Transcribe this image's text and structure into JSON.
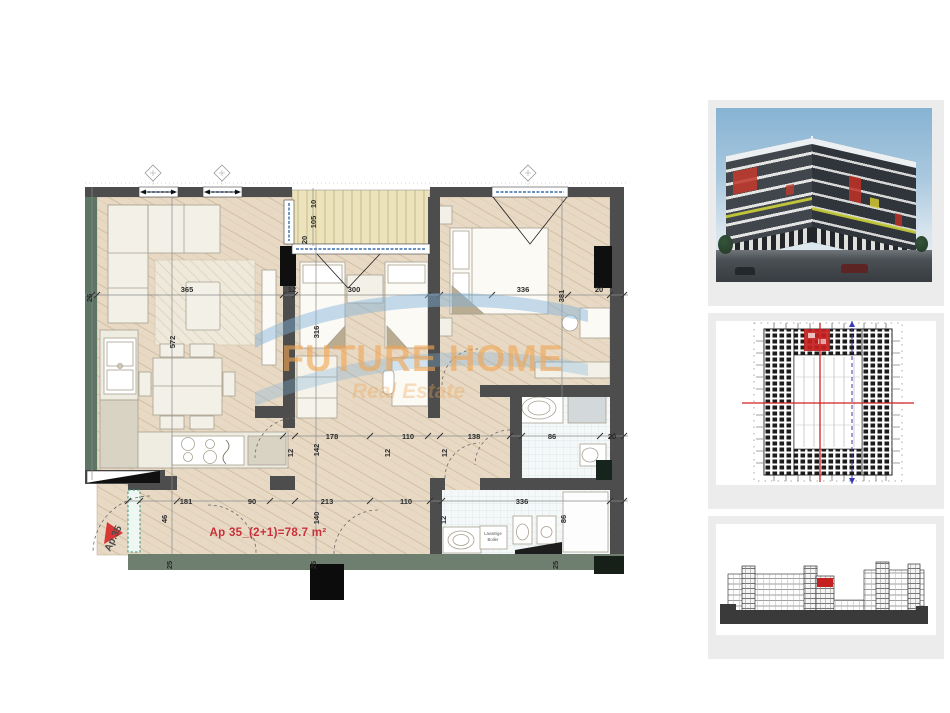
{
  "plan": {
    "apartment_label": "Ap 35_(2+1)=78.7 m²",
    "entrance_label": "Ap.35",
    "boiler_label_line1": "Lavatrige",
    "boiler_label_line2": "Boiler",
    "watermark_line1": "FUTURE HOME",
    "watermark_line2": "Real Estate",
    "dimensions": [
      {
        "t": "25",
        "x": 12,
        "y": 138,
        "r": -90
      },
      {
        "t": "365",
        "x": 107,
        "y": 132,
        "r": 0
      },
      {
        "t": "12",
        "x": 212,
        "y": 132,
        "r": 0
      },
      {
        "t": "300",
        "x": 274,
        "y": 132,
        "r": 0
      },
      {
        "t": "336",
        "x": 443,
        "y": 132,
        "r": 0
      },
      {
        "t": "381",
        "x": 484,
        "y": 136,
        "r": -90
      },
      {
        "t": "20",
        "x": 519,
        "y": 132,
        "r": 0
      },
      {
        "t": "572",
        "x": 95,
        "y": 182,
        "r": -90
      },
      {
        "t": "316",
        "x": 239,
        "y": 172,
        "r": -90
      },
      {
        "t": "10",
        "x": 236,
        "y": 44,
        "r": -90
      },
      {
        "t": "105",
        "x": 236,
        "y": 62,
        "r": -90
      },
      {
        "t": "20",
        "x": 227,
        "y": 80,
        "r": -90
      },
      {
        "t": "178",
        "x": 252,
        "y": 279,
        "r": 0
      },
      {
        "t": "110",
        "x": 328,
        "y": 279,
        "r": 0
      },
      {
        "t": "138",
        "x": 394,
        "y": 279,
        "r": 0
      },
      {
        "t": "86",
        "x": 472,
        "y": 279,
        "r": 0
      },
      {
        "t": "20",
        "x": 532,
        "y": 279,
        "r": 0
      },
      {
        "t": "12",
        "x": 213,
        "y": 293,
        "r": -90
      },
      {
        "t": "142",
        "x": 239,
        "y": 290,
        "r": -90
      },
      {
        "t": "12",
        "x": 310,
        "y": 293,
        "r": -90
      },
      {
        "t": "12",
        "x": 367,
        "y": 293,
        "r": -90
      },
      {
        "t": "12",
        "x": 366,
        "y": 360,
        "r": -90
      },
      {
        "t": "86",
        "x": 486,
        "y": 359,
        "r": -90
      },
      {
        "t": "140",
        "x": 239,
        "y": 358,
        "r": -90
      },
      {
        "t": "46",
        "x": 87,
        "y": 359,
        "r": -90
      },
      {
        "t": "181",
        "x": 106,
        "y": 344,
        "r": 0
      },
      {
        "t": "90",
        "x": 172,
        "y": 344,
        "r": 0
      },
      {
        "t": "213",
        "x": 247,
        "y": 344,
        "r": 0
      },
      {
        "t": "110",
        "x": 326,
        "y": 344,
        "r": 0
      },
      {
        "t": "336",
        "x": 442,
        "y": 344,
        "r": 0
      },
      {
        "t": "25",
        "x": 92,
        "y": 405,
        "r": -90
      },
      {
        "t": "25",
        "x": 236,
        "y": 405,
        "r": -90
      },
      {
        "t": "25",
        "x": 478,
        "y": 405,
        "r": -90
      }
    ]
  },
  "colors": {
    "wall_gray": "#4d4d4d",
    "wall_green": "#5d7565",
    "wall_bottom_green": "#6e7f70",
    "floor_tan": "#e7d9c4",
    "balcony_stripe": "#ece3bd",
    "label_red": "#c9303a",
    "unit_highlight_red": "#c42020",
    "watermark_orange": "#f0a45c",
    "logo_blue": "#7fb2dc",
    "render_sky_blue": "#87b3d4",
    "render_accent_red": "#c03a2e",
    "render_accent_yellow": "#cdd23a"
  }
}
